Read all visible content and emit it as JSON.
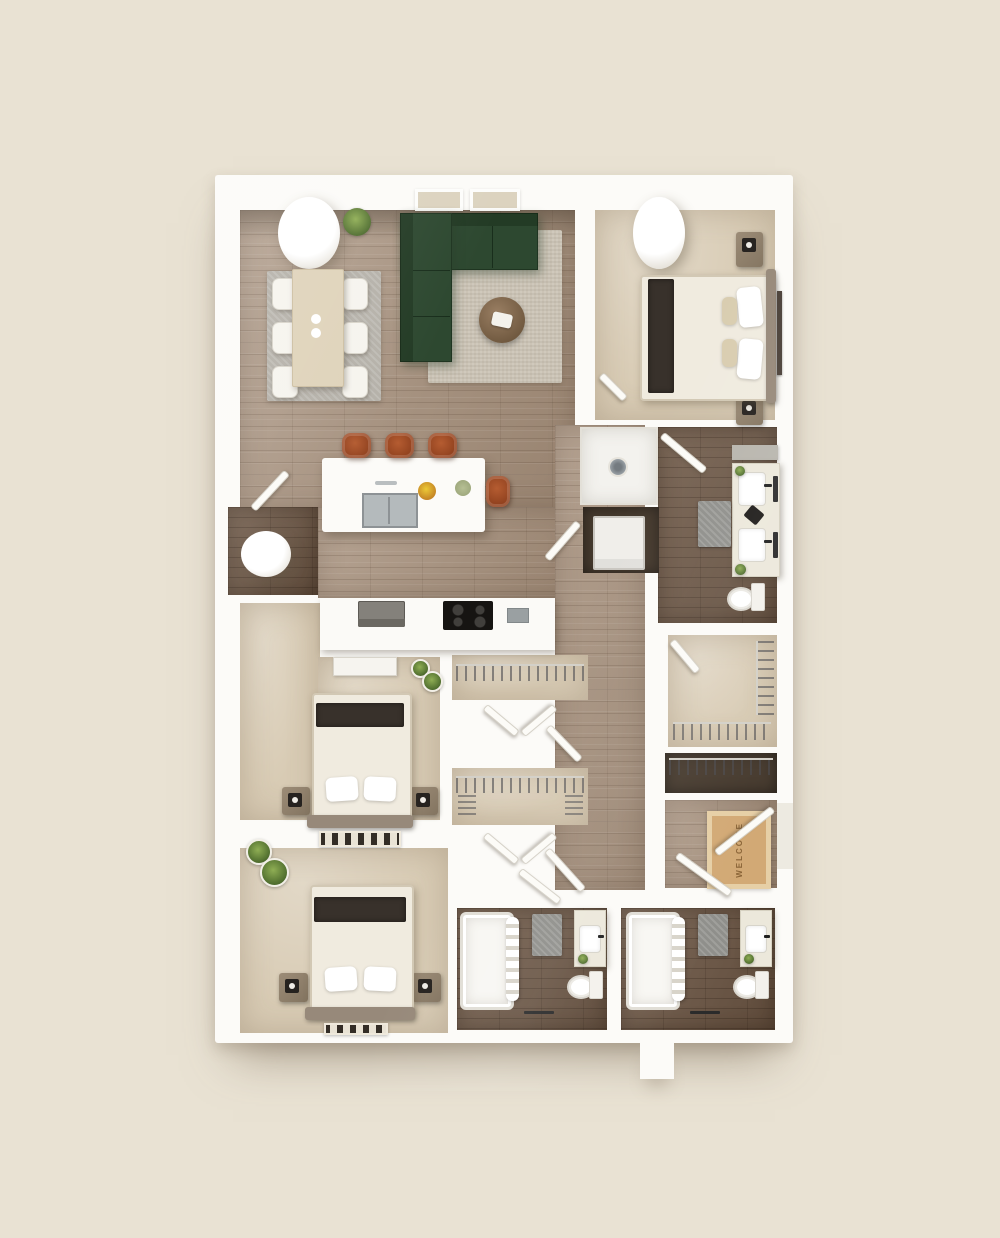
{
  "scene": {
    "type": "3d-floor-plan-top-down-render",
    "welcome_mat_text": "WELCOME",
    "background_color": "#e9e2d3",
    "wall_color": "#fcfbf8",
    "floor_colors": {
      "hardwood_main": "#a7917d",
      "dark_wood_tile": "#6e5846",
      "carpet": "#d8cbb4",
      "utility_dark": "#463a2e"
    },
    "accent_colors": {
      "sofa_green": "#2d4830",
      "stool_rust": "#a9552e",
      "bed_throw_dark": "#38312b",
      "welcome_mat_tan": "#d2a975",
      "plant_green": "#5f7a3a"
    }
  },
  "rooms": [
    {
      "name": "living-dining-kitchen",
      "floor": "hardwood"
    },
    {
      "name": "bedroom-1",
      "floor": "carpet"
    },
    {
      "name": "bathroom-1",
      "floor": "dark-wood-tile"
    },
    {
      "name": "walk-in-closet",
      "floor": "carpet"
    },
    {
      "name": "linen-closet",
      "floor": "dark-wood"
    },
    {
      "name": "entry-foyer",
      "floor": "hardwood"
    },
    {
      "name": "utility-room",
      "floor": "dark-wood"
    },
    {
      "name": "laundry-closet",
      "floor": "dark-wood"
    },
    {
      "name": "shower-room",
      "floor": "white-tile"
    },
    {
      "name": "bedroom-2",
      "floor": "carpet"
    },
    {
      "name": "bedroom-3",
      "floor": "carpet"
    },
    {
      "name": "bathroom-2",
      "floor": "dark-wood-tile"
    },
    {
      "name": "bathroom-3",
      "floor": "dark-wood-tile"
    }
  ],
  "furniture_counts": {
    "beds": 3,
    "dining_chairs": 6,
    "bar_stools": 4,
    "sofas": 1,
    "toilets": 3,
    "bathtubs": 2,
    "showers": 1,
    "sinks_bathroom": 4,
    "closets_with_hangers": 4,
    "washer_dryer": 1
  }
}
